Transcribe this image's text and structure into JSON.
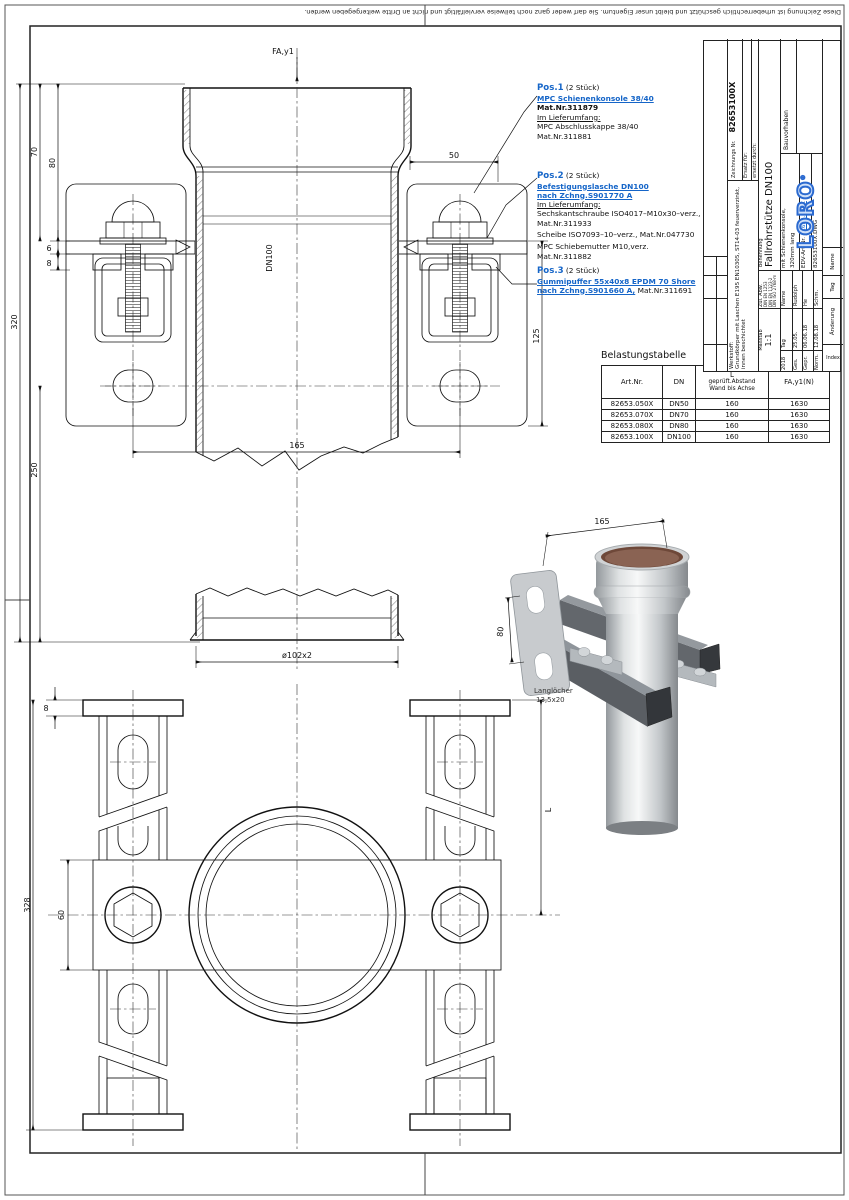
{
  "page": {
    "copyright": "Diese Zeichnung ist urheberrechtlich geschützt und bleibt unser Eigentum. Sie darf weder ganz noch teilweise vervielfältigt und nicht an Dritte weitergegeben werden."
  },
  "front_view": {
    "force_label": "FA,y1",
    "pipe_label": "DN100",
    "dim_70": "70",
    "dim_80": "80",
    "dim_6": "6",
    "dim_8": "8",
    "dim_320": "320",
    "dim_250": "250",
    "dim_50": "50",
    "dim_125": "125",
    "dim_165": "165",
    "dim_dia": "ø102x2"
  },
  "bottom_view": {
    "dim_8": "8",
    "dim_328": "328",
    "dim_60": "60",
    "dim_L": "L"
  },
  "iso_view": {
    "dim_165": "165",
    "dim_80": "80",
    "slot_note_1": "Langlöcher",
    "slot_note_2": "13,5x20"
  },
  "annotations": {
    "pos1": {
      "title": "Pos.1",
      "qty": "(2 Stück)",
      "link": "MPC Schienenkonsole 38/40",
      "mat": "Mat.Nr.311879",
      "scope_label": "Im Lieferumfang:",
      "item1": "MPC Abschlusskappe 38/40",
      "item1_mat": "Mat.Nr.311881"
    },
    "pos2": {
      "title": "Pos.2",
      "qty": "(2 Stück)",
      "link_line1": "Befestigungslasche DN100",
      "link_line2": "nach Zchng.S901770 A",
      "scope_label": "Im Lieferumfang:",
      "item1": "Sechskantschraube ISO4017–M10x30–verz.,",
      "item1_mat": "Mat.Nr.311933",
      "item2": "Scheibe ISO7093–10–verz., Mat.Nr.047730",
      "item3": "MPC Schiebemutter M10,verz.",
      "item3_mat": "Mat.Nr.311882"
    },
    "pos3": {
      "title": "Pos.3",
      "qty": "(2 Stück)",
      "link_line1": "Gummipuffer 55x40x8 EPDM 70 Shore",
      "link_line2": "nach Zchng.S901660 A,",
      "mat": "Mat.Nr.311691"
    }
  },
  "load_table": {
    "title": "Belastungstabelle",
    "col1": "Art.Nr.",
    "col2": "DN",
    "col3_line1": "L",
    "col3_line2": "geprüft.Abstand",
    "col3_line3": "Wand bis Achse",
    "col4": "FA,y1(N)",
    "rows": [
      [
        "82653.050X",
        "DN50",
        "160",
        "1630"
      ],
      [
        "82653.070X",
        "DN70",
        "160",
        "1630"
      ],
      [
        "82653.080X",
        "DN80",
        "160",
        "1630"
      ],
      [
        "82653.100X",
        "DN100",
        "160",
        "1630"
      ]
    ]
  },
  "title_block": {
    "werkstoff_label": "Werkstoff:",
    "werkstoff_value": "Grundkörper mit Laschen E195 EN10305, ST14-03 feuerverzinkt, innen beschichtet",
    "zeichnung_label": "Zeichnungs Nr.",
    "zeichnung_nr": "82653100X",
    "ersatz_label": "Ersatz für:",
    "ersetzt_label": "ersetzt durch:",
    "massstab_label": "Maßstab",
    "massstab": "1:1",
    "zul_abw_label": "Zul. Abw.",
    "zul_abw_1": "DIN EN 1253",
    "zul_abw_2": "DIN EN 1123-2",
    "zul_abw_3": "DIN ISO 2768-m",
    "benennung_label": "Benennung",
    "benennung_1": "Fallrohrstütze DN100",
    "benennung_2": "mit Schienenkonsole,",
    "benennung_3": "320mm lang",
    "edv_label": "EDV-Art.Nr.",
    "edv_nr": "82653.100X",
    "dwg_file": "82653100X.DWG",
    "bauvorhaben": "Bauvorhaben",
    "year": "2018",
    "tag_label": "Tag",
    "name_label": "Name",
    "sign_rows": [
      {
        "role": "Ges.",
        "date": "25.05.",
        "name": "Rudolph"
      },
      {
        "role": "Gepr.",
        "date": "06.06.18",
        "name": "He"
      },
      {
        "role": "Norm.",
        "date": "12.08.18",
        "name": "Schm."
      }
    ],
    "logo": "LORO",
    "logo_reg": "®"
  },
  "revision_strip": {
    "index": "Index",
    "aenderung": "Änderung",
    "tag": "Tag",
    "name": "Name"
  }
}
